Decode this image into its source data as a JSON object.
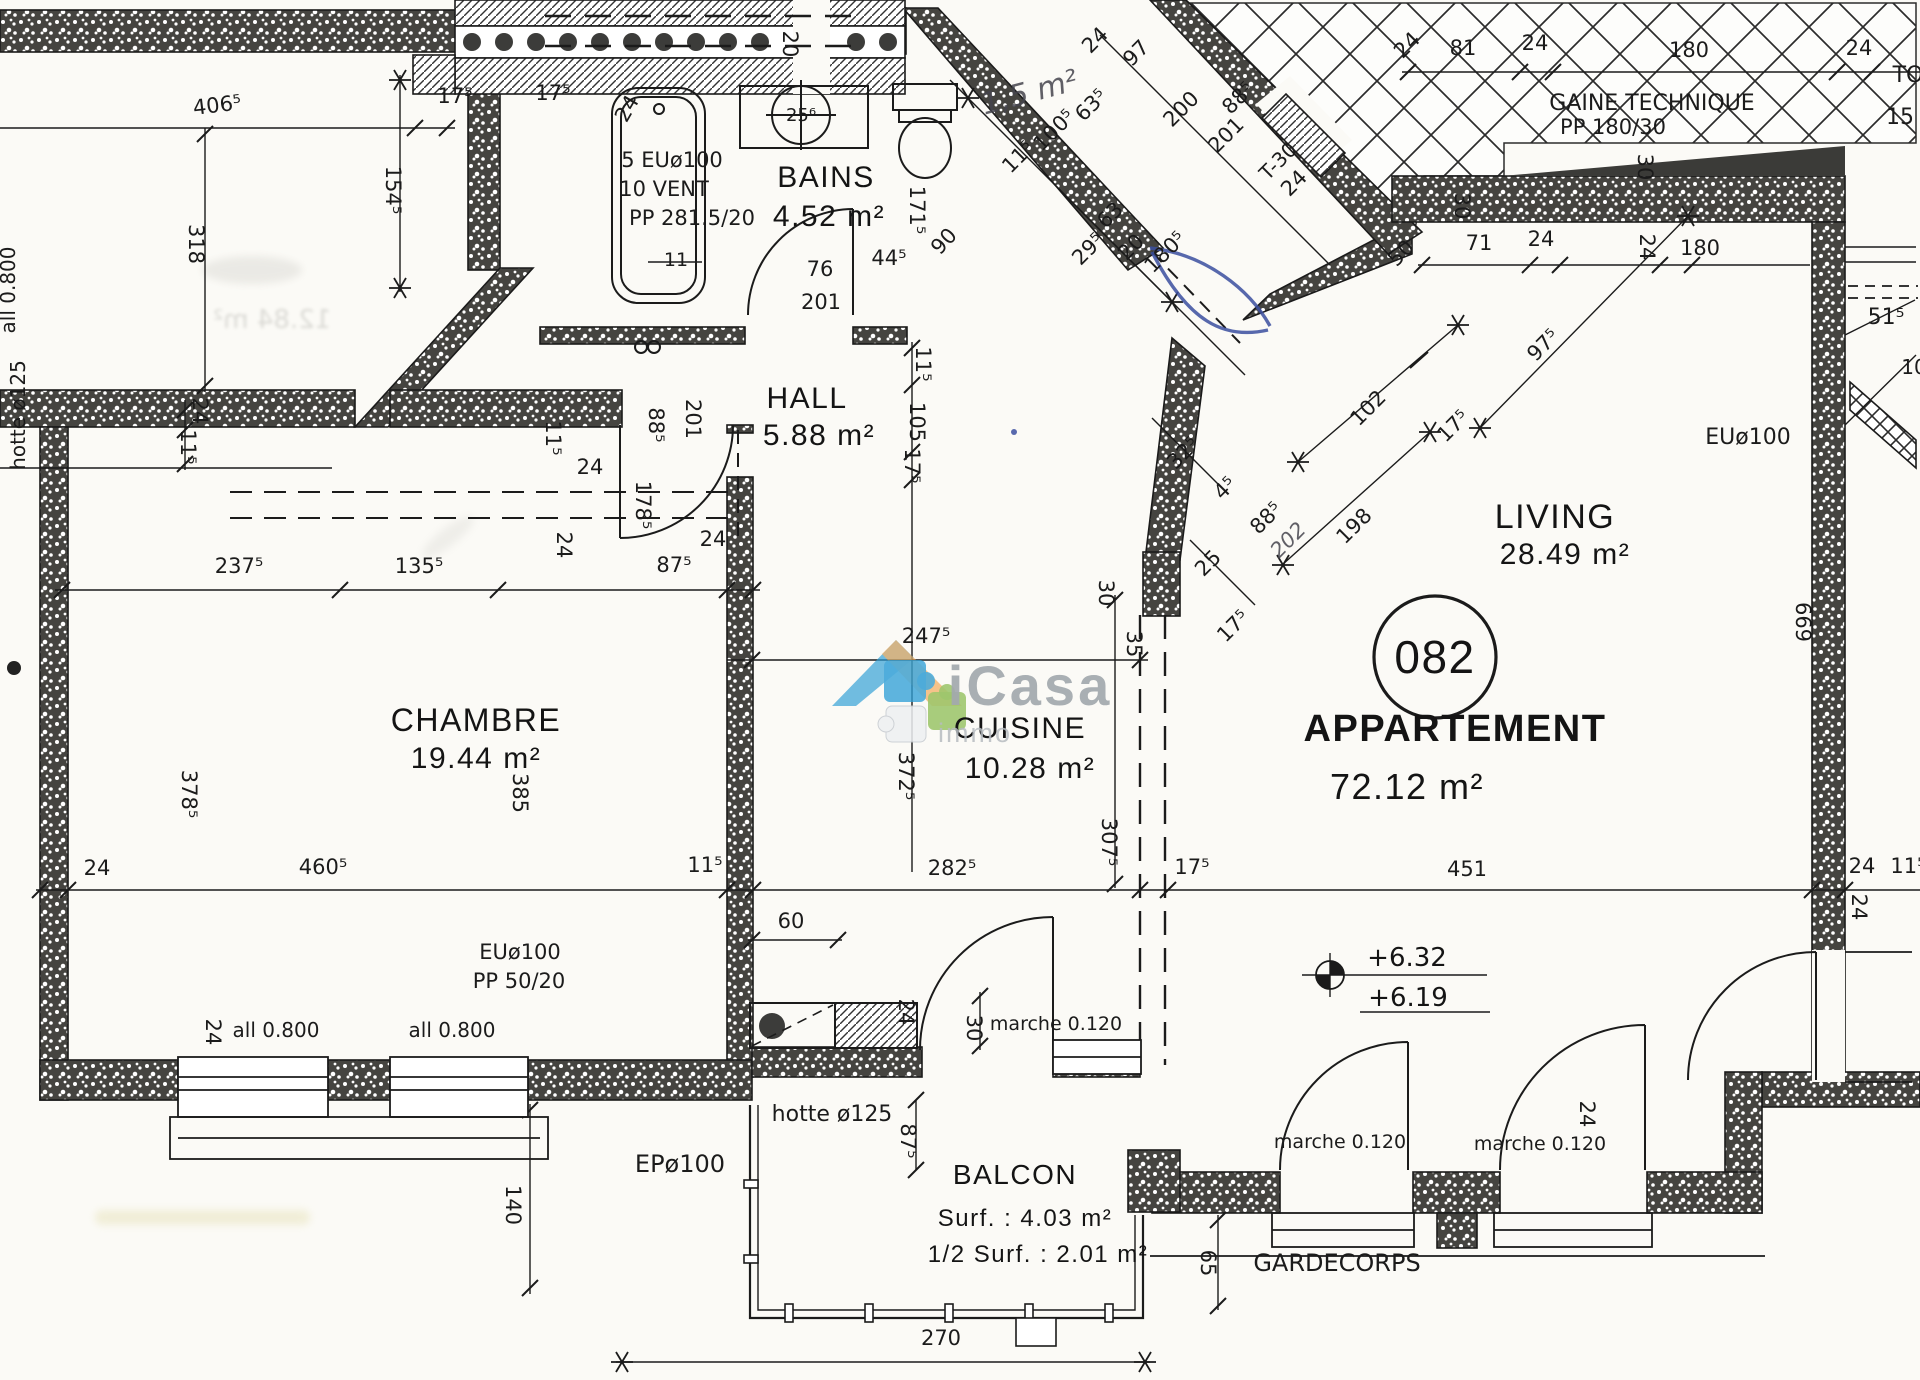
{
  "title": "Plan d'étage — Appartement 082",
  "apartment": {
    "circle_number": "082",
    "label": "APPARTEMENT",
    "area": "72.12 m²"
  },
  "rooms": [
    {
      "name": "BAINS",
      "area": "4.52 m²"
    },
    {
      "name": "HALL",
      "area": "5.88 m²"
    },
    {
      "name": "CHAMBRE",
      "area": "19.44 m²"
    },
    {
      "name": "CUISINE",
      "area": "10.28 m²"
    },
    {
      "name": "LIVING",
      "area": "28.49 m²"
    },
    {
      "name": "BALCON",
      "area": "Surf. : 4.03 m²",
      "area_half": "1/2 Surf. : 2.01 m²"
    }
  ],
  "levels": {
    "upper": "+6.32",
    "lower": "+6.19"
  },
  "watermark": {
    "brand": "iCasa",
    "suffix": "immo"
  },
  "labels": [
    {
      "t": "BAINS",
      "x": 826,
      "y": 187,
      "s": 30,
      "c": "room",
      "n": "room-label-bains"
    },
    {
      "t": "4.52 m²",
      "x": 829,
      "y": 226,
      "s": 30,
      "c": "room",
      "n": "room-area-bains"
    },
    {
      "t": "HALL",
      "x": 807,
      "y": 408,
      "s": 30,
      "c": "room",
      "n": "room-label-hall"
    },
    {
      "t": "5.88 m²",
      "x": 819,
      "y": 445,
      "s": 30,
      "c": "room",
      "n": "room-area-hall"
    },
    {
      "t": "CHAMBRE",
      "x": 476,
      "y": 731,
      "s": 32,
      "c": "room",
      "n": "room-label-chambre"
    },
    {
      "t": "19.44 m²",
      "x": 476,
      "y": 768,
      "s": 30,
      "c": "room",
      "n": "room-area-chambre"
    },
    {
      "t": "CUISINE",
      "x": 1020,
      "y": 738,
      "s": 30,
      "c": "room",
      "n": "room-label-cuisine"
    },
    {
      "t": "10.28 m²",
      "x": 1030,
      "y": 778,
      "s": 30,
      "c": "room",
      "n": "room-area-cuisine"
    },
    {
      "t": "LIVING",
      "x": 1555,
      "y": 528,
      "s": 34,
      "c": "room",
      "n": "room-label-living"
    },
    {
      "t": "28.49 m²",
      "x": 1565,
      "y": 564,
      "s": 30,
      "c": "room",
      "n": "room-area-living"
    },
    {
      "t": "BALCON",
      "x": 1015,
      "y": 1184,
      "s": 28,
      "c": "room",
      "n": "room-label-balcon"
    },
    {
      "t": "Surf. : 4.03 m²",
      "x": 1025,
      "y": 1226,
      "s": 24,
      "c": "room",
      "n": "room-area-balcon"
    },
    {
      "t": "1/2 Surf. : 2.01 m²",
      "x": 1038,
      "y": 1262,
      "s": 24,
      "c": "room",
      "n": "room-area-half-balcon"
    },
    {
      "t": "APPARTEMENT",
      "x": 1455,
      "y": 741,
      "s": 38,
      "w": "bold",
      "c": "room",
      "n": "apartment-label"
    },
    {
      "t": "72.12 m²",
      "x": 1407,
      "y": 799,
      "s": 36,
      "c": "room",
      "n": "apartment-area"
    },
    {
      "t": "082",
      "x": 1435,
      "y": 673,
      "s": 46,
      "c": "room",
      "n": "apartment-number"
    },
    {
      "t": "GAINE TECHNIQUE",
      "x": 1652,
      "y": 110,
      "s": 22,
      "c": "ann",
      "n": "gaine-technique-label"
    },
    {
      "t": "PP 180/30",
      "x": 1613,
      "y": 134,
      "s": 21,
      "c": "ann",
      "n": "gaine-technique-size"
    },
    {
      "t": "5 EUø100",
      "x": 672,
      "y": 167,
      "s": 21,
      "c": "ann",
      "n": "duct-note"
    },
    {
      "t": "10 VENT",
      "x": 664,
      "y": 196,
      "s": 21,
      "c": "ann",
      "n": "vent-note"
    },
    {
      "t": "PP 281.5/20",
      "x": 692,
      "y": 225,
      "s": 21,
      "c": "ann",
      "n": "shaft-note"
    },
    {
      "t": "EUø100",
      "x": 1748,
      "y": 444,
      "s": 22,
      "c": "ann",
      "n": "drain-label"
    },
    {
      "t": "EUø100",
      "x": 520,
      "y": 959,
      "s": 21,
      "c": "ann",
      "n": "drain-label"
    },
    {
      "t": "PP 50/20",
      "x": 519,
      "y": 988,
      "s": 21,
      "c": "ann",
      "n": "shaft-label"
    },
    {
      "t": "hotte ø125",
      "x": 832,
      "y": 1121,
      "s": 22,
      "c": "ann",
      "n": "hood-duct-label"
    },
    {
      "t": "EPø100",
      "x": 680,
      "y": 1172,
      "s": 24,
      "c": "ann",
      "n": "rainwater-pipe-label"
    },
    {
      "t": "marche 0.120",
      "x": 1056,
      "y": 1030,
      "s": 19,
      "c": "ann",
      "n": "step-label"
    },
    {
      "t": "marche 0.120",
      "x": 1340,
      "y": 1148,
      "s": 19,
      "c": "ann",
      "n": "step-label"
    },
    {
      "t": "marche 0.120",
      "x": 1540,
      "y": 1150,
      "s": 19,
      "c": "ann",
      "n": "step-label"
    },
    {
      "t": "GARDECORPS",
      "x": 1337,
      "y": 1271,
      "s": 24,
      "c": "ann",
      "n": "guardrail-label"
    },
    {
      "t": "all 0.800",
      "x": 15,
      "y": 290,
      "r": -90,
      "s": 20,
      "c": "ann",
      "n": "sill-height-label"
    },
    {
      "t": "hotte ø125",
      "x": 25,
      "y": 415,
      "r": -90,
      "s": 20,
      "c": "ann",
      "n": "hood-duct-label"
    },
    {
      "t": "all 0.800",
      "x": 276,
      "y": 1037,
      "s": 20,
      "c": "ann",
      "n": "sill-height-label"
    },
    {
      "t": "all 0.800",
      "x": 452,
      "y": 1037,
      "s": 20,
      "c": "ann",
      "n": "sill-height-label"
    },
    {
      "t": "T-30",
      "x": 1283,
      "y": 166,
      "r": -45,
      "s": 20,
      "c": "ann",
      "n": "fire-door-label"
    },
    {
      "t": "1,5 m²",
      "x": 1032,
      "y": 102,
      "r": -15,
      "s": 30,
      "c": "pencil",
      "n": "pencil-area-note"
    },
    {
      "t": "+6.32",
      "x": 1407,
      "y": 966,
      "s": 26,
      "c": "level",
      "n": "level-upper"
    },
    {
      "t": "+6.19",
      "x": 1408,
      "y": 1006,
      "s": 26,
      "c": "level",
      "n": "level-lower"
    },
    {
      "t": "TO",
      "x": 1908,
      "y": 82,
      "s": 22,
      "c": "ann",
      "n": "clipped-text"
    },
    {
      "t": "15",
      "x": 1900,
      "y": 124,
      "s": 22,
      "c": "ann",
      "n": "clipped-text"
    },
    {
      "t": "10",
      "x": 1914,
      "y": 374,
      "s": 20,
      "c": "dim",
      "n": "clipped-dimension"
    },
    {
      "t": "51⁵",
      "x": 1886,
      "y": 324,
      "s": 22,
      "c": "dim",
      "n": "dimension-label"
    },
    {
      "t": "11",
      "x": 676,
      "y": 266,
      "s": 19,
      "c": "dim",
      "n": "dimension-label"
    },
    {
      "t": "25⁶",
      "x": 801,
      "y": 121,
      "s": 18,
      "c": "dim",
      "n": "basin-diameter"
    },
    {
      "t": "406⁵",
      "x": 218,
      "y": 112,
      "r": -7,
      "c": "dim",
      "n": "dimension-label"
    },
    {
      "t": "17⁵",
      "x": 455,
      "y": 103,
      "c": "dim",
      "n": "dimension-label"
    },
    {
      "t": "17⁵",
      "x": 553,
      "y": 100,
      "c": "dim",
      "n": "dimension-label"
    },
    {
      "t": "24",
      "x": 633,
      "y": 112,
      "r": -60,
      "c": "dim",
      "n": "dimension-label"
    },
    {
      "t": "20",
      "x": 783,
      "y": 44,
      "r": 90,
      "c": "dim",
      "n": "dimension-label"
    },
    {
      "t": "171⁵",
      "x": 910,
      "y": 210,
      "r": 90,
      "c": "dim",
      "n": "dimension-label"
    },
    {
      "t": "76",
      "x": 820,
      "y": 276,
      "c": "dim",
      "n": "dimension-label"
    },
    {
      "t": "201",
      "x": 821,
      "y": 309,
      "c": "dim",
      "n": "dimension-label"
    },
    {
      "t": "44⁵",
      "x": 889,
      "y": 265,
      "c": "dim",
      "n": "dimension-label"
    },
    {
      "t": "90",
      "x": 949,
      "y": 246,
      "r": -47,
      "c": "dim",
      "n": "dimension-label"
    },
    {
      "t": "11⁵",
      "x": 916,
      "y": 364,
      "r": 90,
      "c": "dim",
      "n": "dimension-label"
    },
    {
      "t": "105",
      "x": 910,
      "y": 422,
      "r": 90,
      "c": "dim",
      "n": "dimension-label"
    },
    {
      "t": "17⁵",
      "x": 905,
      "y": 466,
      "r": 90,
      "c": "dim",
      "n": "dimension-label"
    },
    {
      "t": "88⁵",
      "x": 649,
      "y": 425,
      "r": 90,
      "c": "dim",
      "n": "dimension-label"
    },
    {
      "t": "201",
      "x": 686,
      "y": 419,
      "r": 90,
      "c": "dim",
      "n": "dimension-label"
    },
    {
      "t": "24",
      "x": 590,
      "y": 474,
      "c": "dim",
      "n": "dimension-label"
    },
    {
      "t": "178⁵",
      "x": 636,
      "y": 505,
      "r": 90,
      "c": "dim",
      "n": "dimension-label"
    },
    {
      "t": "318",
      "x": 189,
      "y": 244,
      "r": 90,
      "c": "dim",
      "n": "dimension-label"
    },
    {
      "t": "154⁵",
      "x": 386,
      "y": 190,
      "r": 90,
      "c": "dim",
      "n": "dimension-label"
    },
    {
      "t": "24",
      "x": 193,
      "y": 411,
      "r": 90,
      "c": "dim",
      "n": "dimension-label"
    },
    {
      "t": "11⁵",
      "x": 181,
      "y": 447,
      "r": 90,
      "c": "dim",
      "n": "dimension-label"
    },
    {
      "t": "237⁵",
      "x": 239,
      "y": 573,
      "c": "dim",
      "n": "dimension-label"
    },
    {
      "t": "135⁵",
      "x": 419,
      "y": 573,
      "c": "dim",
      "n": "dimension-label"
    },
    {
      "t": "87⁵",
      "x": 674,
      "y": 572,
      "c": "dim",
      "n": "dimension-label"
    },
    {
      "t": "24",
      "x": 713,
      "y": 546,
      "c": "dim",
      "n": "dimension-label"
    },
    {
      "t": "11⁵",
      "x": 546,
      "y": 438,
      "r": 90,
      "c": "dim",
      "n": "dimension-label"
    },
    {
      "t": "24",
      "x": 557,
      "y": 545,
      "r": 90,
      "c": "dim",
      "n": "dimension-label"
    },
    {
      "t": "378⁵",
      "x": 182,
      "y": 794,
      "r": 90,
      "c": "dim",
      "n": "dimension-label"
    },
    {
      "t": "385",
      "x": 513,
      "y": 793,
      "r": 90,
      "c": "dim",
      "n": "dimension-label"
    },
    {
      "t": "24",
      "x": 97,
      "y": 875,
      "c": "dim",
      "n": "dimension-label"
    },
    {
      "t": "460⁵",
      "x": 323,
      "y": 874,
      "c": "dim",
      "n": "dimension-label"
    },
    {
      "t": "11⁵",
      "x": 705,
      "y": 872,
      "c": "dim",
      "n": "dimension-label"
    },
    {
      "t": "282⁵",
      "x": 952,
      "y": 875,
      "c": "dim",
      "n": "dimension-label"
    },
    {
      "t": "17⁵",
      "x": 1192,
      "y": 874,
      "c": "dim",
      "n": "dimension-label"
    },
    {
      "t": "451",
      "x": 1467,
      "y": 876,
      "c": "dim",
      "n": "dimension-label"
    },
    {
      "t": "24",
      "x": 1862,
      "y": 873,
      "c": "dim",
      "n": "dimension-label"
    },
    {
      "t": "11⁵",
      "x": 1908,
      "y": 873,
      "c": "dim",
      "n": "dimension-label"
    },
    {
      "t": "372⁵",
      "x": 899,
      "y": 776,
      "r": 90,
      "c": "dim",
      "n": "dimension-label"
    },
    {
      "t": "307⁵",
      "x": 1102,
      "y": 842,
      "r": 90,
      "c": "dim",
      "n": "dimension-label"
    },
    {
      "t": "247⁵",
      "x": 926,
      "y": 643,
      "c": "dim",
      "n": "dimension-label"
    },
    {
      "t": "30",
      "x": 1099,
      "y": 593,
      "r": 90,
      "c": "dim",
      "n": "dimension-label"
    },
    {
      "t": "35",
      "x": 1127,
      "y": 644,
      "r": 90,
      "c": "dim",
      "n": "dimension-label"
    },
    {
      "t": "60",
      "x": 791,
      "y": 928,
      "c": "dim",
      "n": "dimension-label"
    },
    {
      "t": "24",
      "x": 899,
      "y": 1012,
      "r": 90,
      "c": "dim",
      "n": "dimension-label"
    },
    {
      "t": "30",
      "x": 967,
      "y": 1028,
      "r": 90,
      "c": "dim",
      "n": "dimension-label"
    },
    {
      "t": "87⁵",
      "x": 901,
      "y": 1141,
      "r": 90,
      "c": "dim",
      "n": "dimension-label"
    },
    {
      "t": "140",
      "x": 506,
      "y": 1205,
      "r": 90,
      "c": "dim",
      "n": "dimension-label"
    },
    {
      "t": "24",
      "x": 206,
      "y": 1032,
      "r": 90,
      "c": "dim",
      "n": "dimension-label"
    },
    {
      "t": "270",
      "x": 941,
      "y": 1345,
      "c": "dim",
      "n": "dimension-label"
    },
    {
      "t": "65",
      "x": 1201,
      "y": 1263,
      "r": 90,
      "c": "dim",
      "n": "dimension-label"
    },
    {
      "t": "24",
      "x": 1580,
      "y": 1114,
      "r": 90,
      "c": "dim",
      "n": "dimension-label"
    },
    {
      "t": "24",
      "x": 1852,
      "y": 907,
      "r": 90,
      "c": "dim",
      "n": "dimension-label"
    },
    {
      "t": "669",
      "x": 1796,
      "y": 622,
      "r": 90,
      "c": "dim",
      "n": "dimension-label"
    },
    {
      "t": "102",
      "x": 1373,
      "y": 413,
      "r": -45,
      "c": "dim",
      "n": "dimension-label"
    },
    {
      "t": "17⁵",
      "x": 1458,
      "y": 431,
      "r": -45,
      "c": "dim",
      "n": "dimension-label"
    },
    {
      "t": "97⁵",
      "x": 1548,
      "y": 350,
      "r": -45,
      "c": "dim",
      "n": "dimension-label"
    },
    {
      "t": "198",
      "x": 1359,
      "y": 531,
      "r": -45,
      "c": "dim",
      "n": "dimension-label"
    },
    {
      "t": "32⁵",
      "x": 1188,
      "y": 458,
      "r": -45,
      "c": "dim",
      "n": "dimension-label"
    },
    {
      "t": "4⁵",
      "x": 1230,
      "y": 493,
      "r": -45,
      "c": "dim",
      "n": "dimension-label"
    },
    {
      "t": "88⁵",
      "x": 1271,
      "y": 523,
      "r": -45,
      "c": "dim",
      "n": "dimension-label"
    },
    {
      "t": "202",
      "x": 1293,
      "y": 545,
      "r": -45,
      "c": "pencil",
      "n": "pen-dimension"
    },
    {
      "t": "25",
      "x": 1213,
      "y": 568,
      "r": -45,
      "c": "dim",
      "n": "dimension-label"
    },
    {
      "t": "17⁵",
      "x": 1238,
      "y": 631,
      "r": -45,
      "c": "dim",
      "n": "dimension-label"
    },
    {
      "t": "11⁵",
      "x": 1023,
      "y": 162,
      "r": -45,
      "c": "dim",
      "n": "dimension-label"
    },
    {
      "t": "100⁵",
      "x": 1059,
      "y": 135,
      "r": -45,
      "c": "dim",
      "n": "dimension-label"
    },
    {
      "t": "63⁵",
      "x": 1096,
      "y": 110,
      "r": -45,
      "c": "dim",
      "n": "dimension-label"
    },
    {
      "t": "29⁵",
      "x": 1093,
      "y": 254,
      "r": -45,
      "c": "dim",
      "n": "dimension-label"
    },
    {
      "t": "63",
      "x": 1115,
      "y": 220,
      "r": -45,
      "c": "dim",
      "n": "dimension-label"
    },
    {
      "t": "20",
      "x": 1136,
      "y": 252,
      "r": -45,
      "c": "dim",
      "n": "dimension-label"
    },
    {
      "t": "180⁵",
      "x": 1170,
      "y": 257,
      "r": -45,
      "c": "dim",
      "n": "dimension-label"
    },
    {
      "t": "24",
      "x": 1100,
      "y": 45,
      "r": -45,
      "c": "dim",
      "n": "dimension-label"
    },
    {
      "t": "97",
      "x": 1141,
      "y": 58,
      "r": -45,
      "c": "dim",
      "n": "dimension-label"
    },
    {
      "t": "200",
      "x": 1186,
      "y": 114,
      "r": -45,
      "c": "dim",
      "n": "dimension-label"
    },
    {
      "t": "201",
      "x": 1231,
      "y": 140,
      "r": -45,
      "c": "dim",
      "n": "dimension-label"
    },
    {
      "t": "88⁵",
      "x": 1243,
      "y": 103,
      "r": -45,
      "c": "dim",
      "n": "dimension-label"
    },
    {
      "t": "24",
      "x": 1299,
      "y": 188,
      "r": -45,
      "c": "dim",
      "n": "dimension-label"
    },
    {
      "t": "24",
      "x": 1412,
      "y": 50,
      "r": -45,
      "c": "dim",
      "n": "dimension-label"
    },
    {
      "t": "81",
      "x": 1463,
      "y": 55,
      "c": "dim",
      "n": "dimension-label"
    },
    {
      "t": "24",
      "x": 1535,
      "y": 50,
      "c": "dim",
      "n": "dimension-label"
    },
    {
      "t": "180",
      "x": 1689,
      "y": 57,
      "c": "dim",
      "n": "dimension-label"
    },
    {
      "t": "24",
      "x": 1859,
      "y": 55,
      "c": "dim",
      "n": "dimension-label"
    },
    {
      "t": "50",
      "x": 1406,
      "y": 258,
      "r": -45,
      "c": "dim",
      "n": "dimension-label"
    },
    {
      "t": "71",
      "x": 1479,
      "y": 250,
      "c": "dim",
      "n": "dimension-label"
    },
    {
      "t": "24",
      "x": 1541,
      "y": 246,
      "c": "dim",
      "n": "dimension-label"
    },
    {
      "t": "24",
      "x": 1640,
      "y": 247,
      "r": 90,
      "c": "dim",
      "n": "dimension-label"
    },
    {
      "t": "180",
      "x": 1700,
      "y": 255,
      "c": "dim",
      "n": "dimension-label"
    },
    {
      "t": "30",
      "x": 1455,
      "y": 206,
      "r": 90,
      "c": "dim",
      "n": "dimension-label"
    },
    {
      "t": "30",
      "x": 1638,
      "y": 167,
      "r": 90,
      "c": "dim",
      "n": "dimension-label"
    },
    {
      "t": "iCasa",
      "x": 1030,
      "y": 705,
      "s": 56,
      "w": "bold",
      "c": "brand",
      "n": "watermark-brand"
    },
    {
      "t": "immo",
      "x": 975,
      "y": 742,
      "s": 27,
      "c": "sub",
      "n": "watermark-suffix"
    },
    {
      "t": "12.84 m²",
      "x": 272,
      "y": 328,
      "s": 26,
      "c": "bleed",
      "n": "bleed-through-text"
    }
  ]
}
